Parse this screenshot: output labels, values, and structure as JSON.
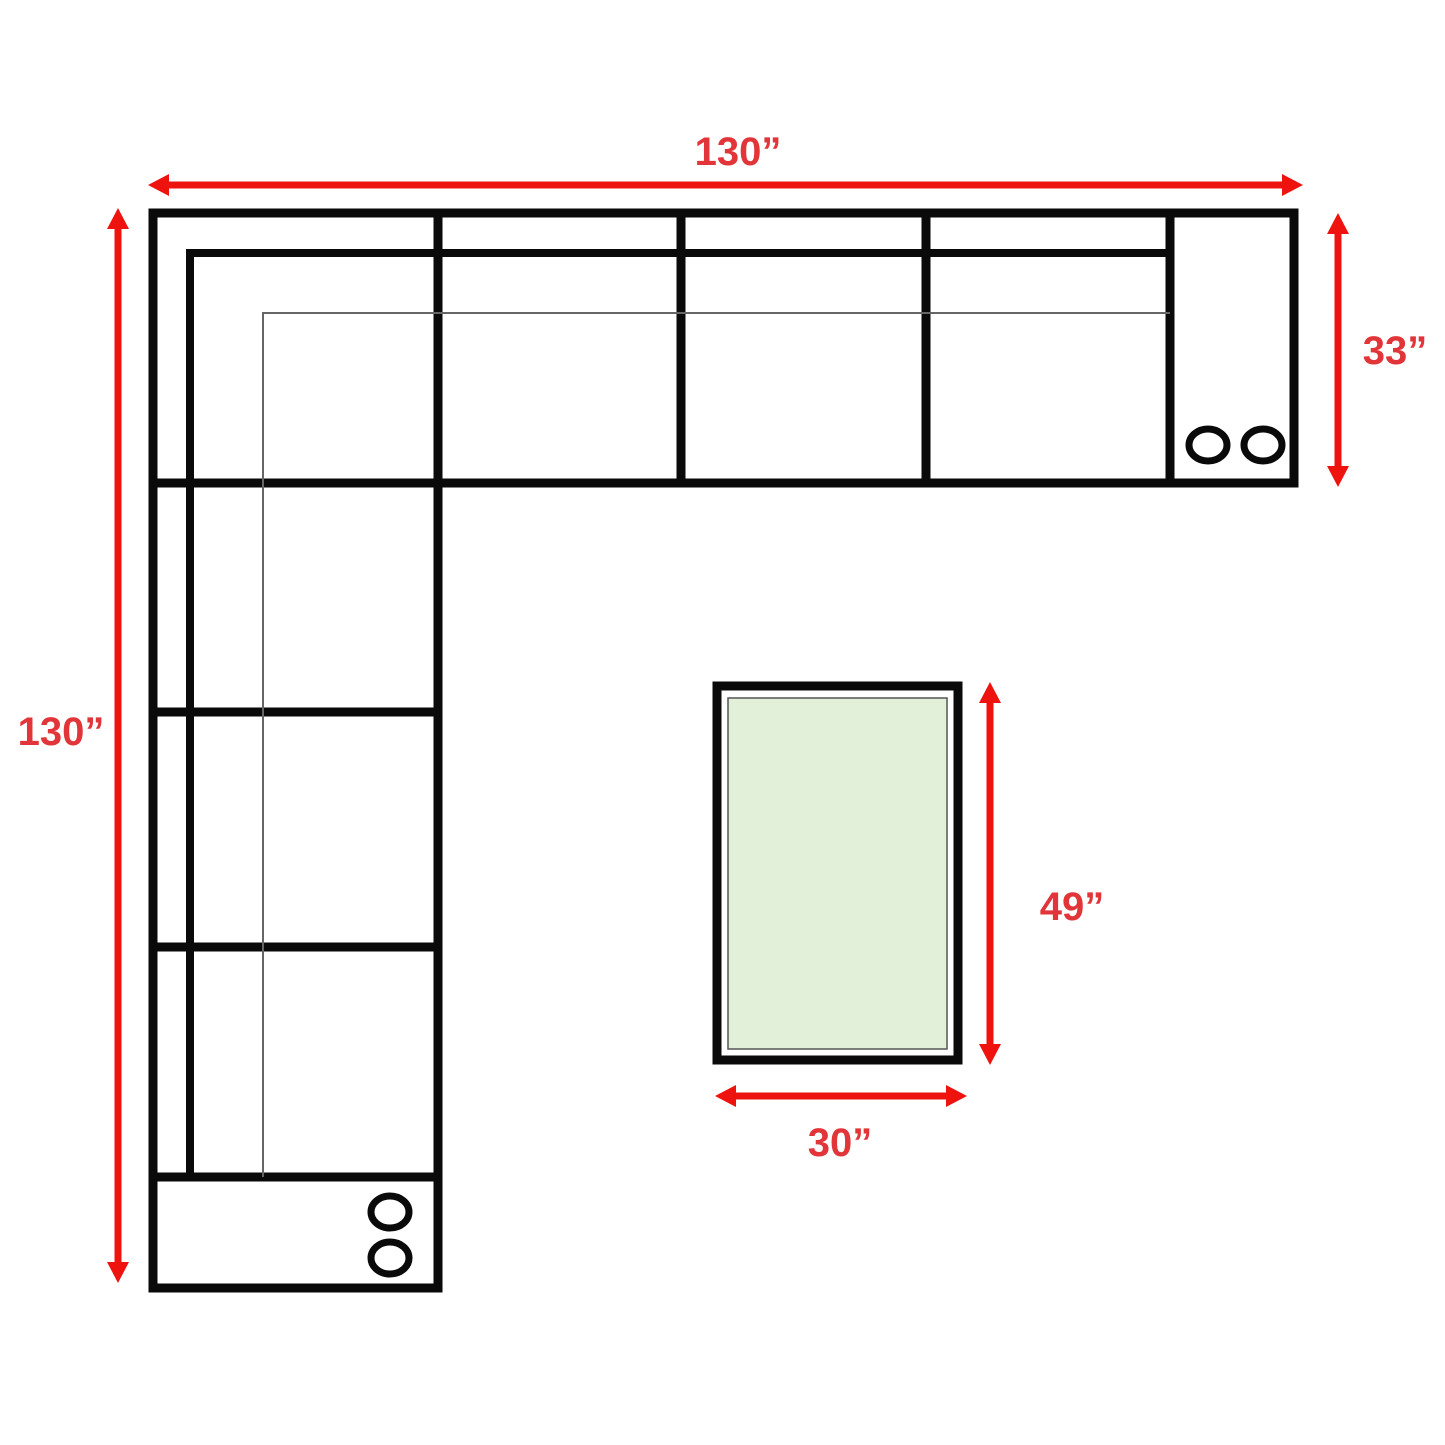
{
  "diagram": {
    "dimensions": {
      "sofa_width": "130”",
      "sofa_depth": "130”",
      "section_depth": "33”",
      "table_length": "49”",
      "table_width": "30”"
    },
    "colors": {
      "arrow": "#ef1310",
      "label": "#e23539",
      "outline": "#0a0a0a",
      "seam_line": "#666666",
      "table_fill": "#e2efd9"
    }
  }
}
